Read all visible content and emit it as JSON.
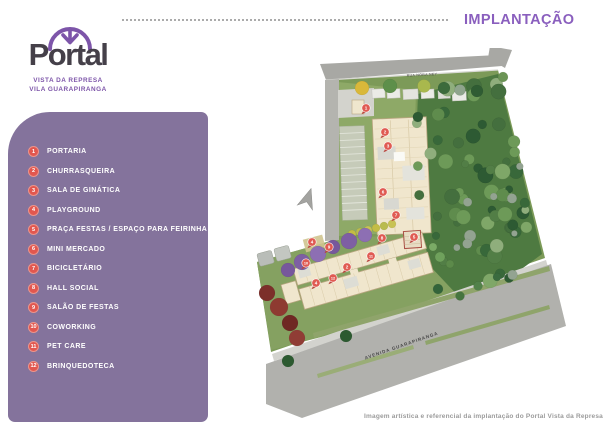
{
  "header": {
    "title": "IMPLANTAÇÃO"
  },
  "logo": {
    "name": "Portal",
    "subtitle1": "VISTA DA REPRESA",
    "subtitle2": "VILA GUARAPIRANGA"
  },
  "legend": {
    "items": [
      {
        "num": "1",
        "label": "PORTARIA"
      },
      {
        "num": "2",
        "label": "CHURRASQUEIRA"
      },
      {
        "num": "3",
        "label": "SALA DE GINÁTICA"
      },
      {
        "num": "4",
        "label": "PLAYGROUND"
      },
      {
        "num": "5",
        "label": "PRAÇA FESTAS / ESPAÇO PARA FEIRINHA"
      },
      {
        "num": "6",
        "label": "MINI MERCADO"
      },
      {
        "num": "7",
        "label": "BICICLETÁRIO"
      },
      {
        "num": "8",
        "label": "HALL SOCIAL"
      },
      {
        "num": "9",
        "label": "SALÃO DE FESTAS"
      },
      {
        "num": "10",
        "label": "COWORKING"
      },
      {
        "num": "11",
        "label": "PET CARE"
      },
      {
        "num": "12",
        "label": "BRINQUEDOTECA"
      }
    ]
  },
  "site_plan": {
    "street_top": "RUA NORA NEY",
    "street_bottom": "AVENIDA GUARAPIRANGA",
    "markers": [
      {
        "n": "1",
        "x": 366,
        "y": 108
      },
      {
        "n": "2",
        "x": 385,
        "y": 132
      },
      {
        "n": "3",
        "x": 388,
        "y": 146
      },
      {
        "n": "6",
        "x": 383,
        "y": 192
      },
      {
        "n": "7",
        "x": 396,
        "y": 215
      },
      {
        "n": "8",
        "x": 382,
        "y": 238
      },
      {
        "n": "5",
        "x": 414,
        "y": 237
      },
      {
        "n": "4",
        "x": 312,
        "y": 242
      },
      {
        "n": "9",
        "x": 329,
        "y": 247
      },
      {
        "n": "11",
        "x": 371,
        "y": 256
      },
      {
        "n": "2",
        "x": 347,
        "y": 267
      },
      {
        "n": "10",
        "x": 306,
        "y": 263
      },
      {
        "n": "12",
        "x": 333,
        "y": 278
      },
      {
        "n": "4",
        "x": 316,
        "y": 283
      }
    ]
  },
  "footer": {
    "caption": "Imagem artística e referencial da implantação do Portal Vista da Represa"
  },
  "colors": {
    "accent_purple": "#8a5fbe",
    "panel_purple": "#84739c",
    "logo_purple": "#7d55a9",
    "logo_dark": "#454049",
    "legend_marker_red": "#e2574f",
    "lawn_green": "#7c9a58",
    "forest_green": "#4e7a41",
    "road_gray": "#b1b1ad",
    "purple_tree": "#8d6fb3"
  }
}
